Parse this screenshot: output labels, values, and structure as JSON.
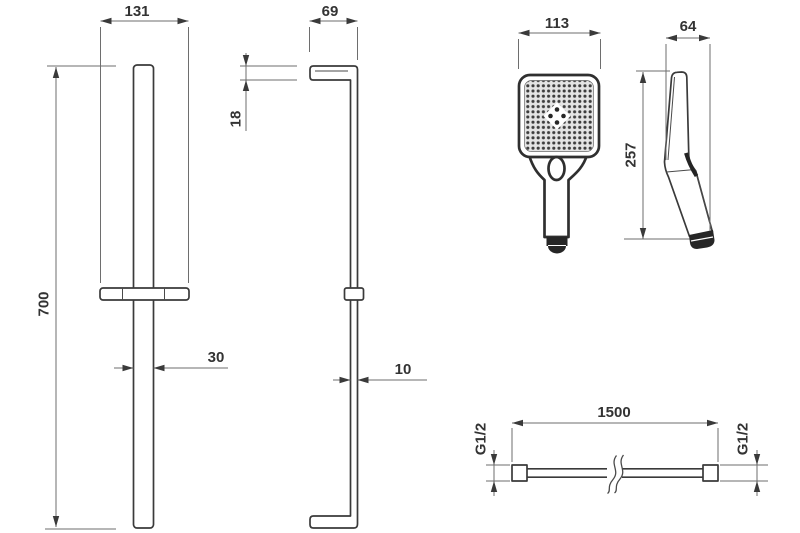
{
  "drawing": {
    "labels": {
      "rail_front": {
        "bracket_width": "131",
        "height": "700",
        "bar_width": "30"
      },
      "rail_side": {
        "depth": "69",
        "arm_thickness": "18",
        "bar_depth": "10"
      },
      "handshower_front": {
        "width": "113",
        "height": "257"
      },
      "handshower_side": {
        "depth": "64"
      },
      "hose": {
        "length": "1500",
        "thread_left": "G1/2",
        "thread_right": "G1/2"
      }
    },
    "colors": {
      "background": "#ffffff",
      "part_line": "#3a3a3a",
      "dimension_line": "#6e6e6e",
      "label_text": "#333333"
    }
  }
}
